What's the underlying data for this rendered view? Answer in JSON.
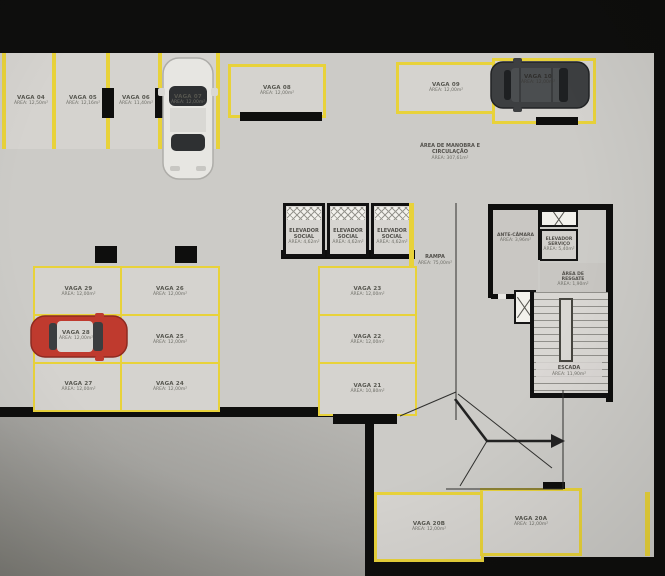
{
  "colors": {
    "line_yellow": "#e8d23a",
    "wall_black": "#0e0e0d",
    "floor_gray": "#cccbc7",
    "spot_gray": "#d5d3cf",
    "car_red": "#bf3a2e",
    "car_white": "#e7e6e2",
    "car_dark": "#3d3f41"
  },
  "maneuver_area": {
    "line1": "ÁREA DE MANOBRA E",
    "line2": "CIRCULAÇÃO",
    "area": "ÁREA: 307,61m²"
  },
  "rooms": {
    "elevador_social": {
      "name": "ELEVADOR SOCIAL",
      "area": "ÁREA: 4,62m²"
    },
    "rampa": {
      "name": "RAMPA",
      "area": "ÁREA: 75,00m²"
    },
    "ante_camara": {
      "name": "ANTE-CÂMARA",
      "area": "ÁREA: 3,96m²"
    },
    "elevador_servico": {
      "name": "ELEVADOR SERVIÇO",
      "area": "ÁREA: 5,40m²"
    },
    "area_resgate": {
      "name": "ÁREA DE RESGATE",
      "area": "ÁREA: 1,90m²"
    },
    "escada": {
      "name": "ESCADA",
      "area": "ÁREA: 11,90m²"
    }
  },
  "spots": {
    "v04": {
      "name": "VAGA 04",
      "area": "ÁREA: 12,50m²"
    },
    "v05": {
      "name": "VAGA 05",
      "area": "ÁREA: 12,16m²"
    },
    "v06": {
      "name": "VAGA 06",
      "area": "ÁREA: 11,40m²"
    },
    "v07": {
      "name": "VAGA 07",
      "area": "ÁREA: 12,00m²"
    },
    "v08": {
      "name": "VAGA 08",
      "area": "ÁREA: 12,00m²"
    },
    "v09": {
      "name": "VAGA 09",
      "area": "ÁREA: 12,00m²"
    },
    "v10": {
      "name": "VAGA 10",
      "area": "ÁREA: 12,00m²"
    },
    "v20a": {
      "name": "VAGA 20A",
      "area": "ÁREA: 12,00m²"
    },
    "v20b": {
      "name": "VAGA 20B",
      "area": "ÁREA: 12,00m²"
    },
    "v21": {
      "name": "VAGA 21",
      "area": "ÁREA: 10,80m²"
    },
    "v22": {
      "name": "VAGA 22",
      "area": "ÁREA: 12,00m²"
    },
    "v23": {
      "name": "VAGA 23",
      "area": "ÁREA: 12,00m²"
    },
    "v24": {
      "name": "VAGA 24",
      "area": "ÁREA: 12,00m²"
    },
    "v25": {
      "name": "VAGA 25",
      "area": "ÁREA: 12,00m²"
    },
    "v26": {
      "name": "VAGA 26",
      "area": "ÁREA: 12,00m²"
    },
    "v27": {
      "name": "VAGA 27",
      "area": "ÁREA: 12,00m²"
    },
    "v28": {
      "name": "VAGA 28",
      "area": "ÁREA: 12,00m²"
    },
    "v29": {
      "name": "VAGA 29",
      "area": "ÁREA: 12,00m²"
    }
  }
}
